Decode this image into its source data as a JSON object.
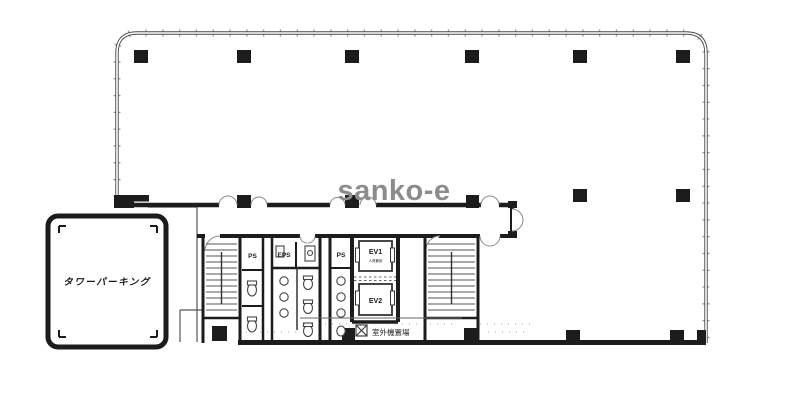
{
  "watermark": "sanko-e",
  "rooms": {
    "parking": "タワーパーキング",
    "ps1": "PS",
    "eps": "EPS",
    "ps2": "PS",
    "ev1": "EV1",
    "ev1_note": "人荷兼用",
    "ev2": "EV2",
    "outdoor_unit_area": "室外機置場"
  },
  "colors": {
    "wall": "#1c1c1c",
    "thin_line": "#555555",
    "window_tick": "#9a9a9a",
    "watermark": "#8c8c8c",
    "background": "#ffffff"
  }
}
